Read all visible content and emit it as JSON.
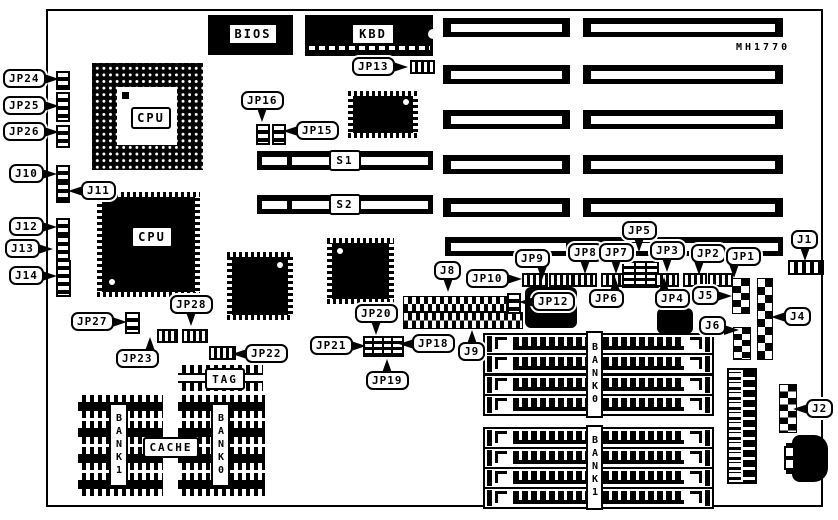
{
  "board": {
    "part_code": "MH1770"
  },
  "chips": {
    "bios": "BIOS",
    "kbd": "KBD",
    "cpu_socket": "CPU",
    "cpu_qfp": "CPU",
    "s1": "S1",
    "s2": "S2",
    "tag": "TAG",
    "cache": "CACHE",
    "cache_bank1": "BANK1",
    "cache_bank0": "BANK0",
    "simm_bank0": "BANK0",
    "simm_bank1": "BANK1"
  },
  "callouts": {
    "jp1": "JP1",
    "jp2": "JP2",
    "jp3": "JP3",
    "jp4": "JP4",
    "jp5": "JP5",
    "jp6": "JP6",
    "jp7": "JP7",
    "jp8": "JP8",
    "jp9": "JP9",
    "jp10": "JP10",
    "jp12": "JP12",
    "jp13": "JP13",
    "jp15": "JP15",
    "jp16": "JP16",
    "jp18": "JP18",
    "jp19": "JP19",
    "jp20": "JP20",
    "jp21": "JP21",
    "jp22": "JP22",
    "jp23": "JP23",
    "jp24": "JP24",
    "jp25": "JP25",
    "jp26": "JP26",
    "jp27": "JP27",
    "jp28": "JP28",
    "j1": "J1",
    "j2": "J2",
    "j4": "J4",
    "j5": "J5",
    "j6": "J6",
    "j8": "J8",
    "j9": "J9",
    "j10": "J10",
    "j11": "J11",
    "j12": "J12",
    "j13": "J13",
    "j14": "J14"
  }
}
